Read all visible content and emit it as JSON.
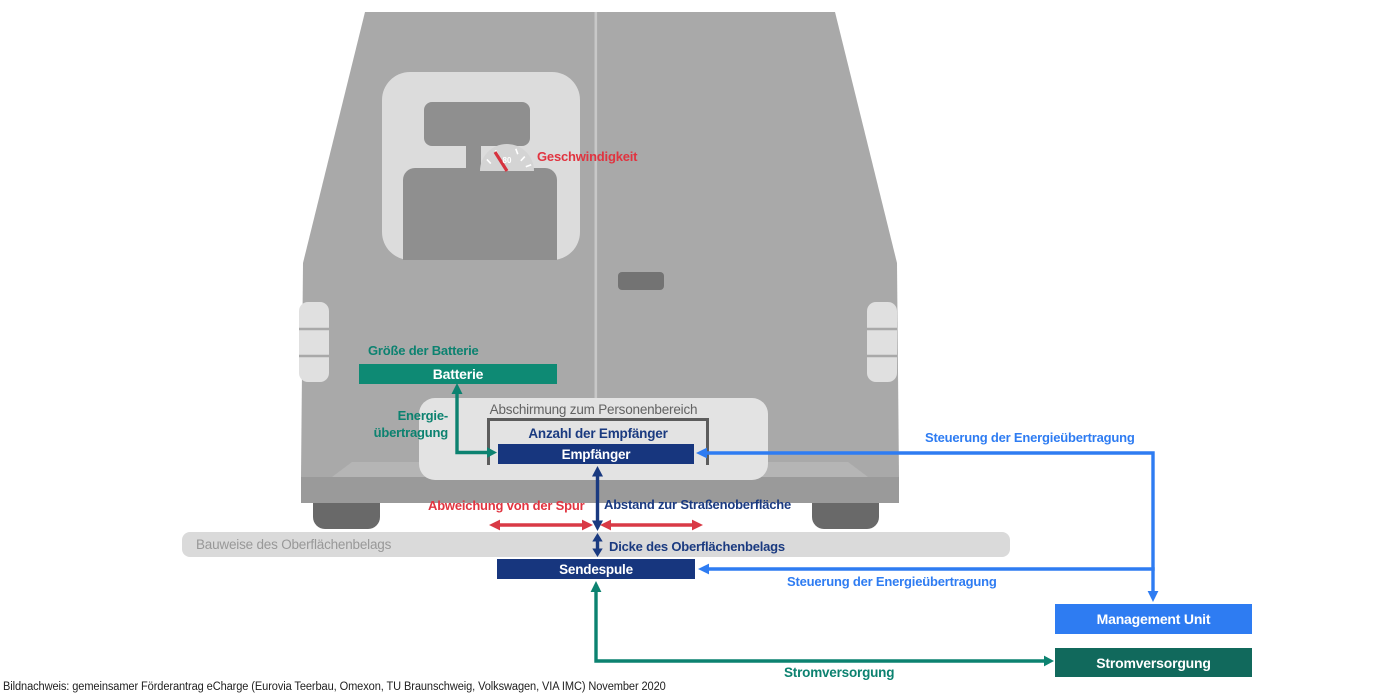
{
  "colors": {
    "teal_line": "#0c8270",
    "teal_box": "#0e8a74",
    "teal_dark_box": "#11695c",
    "navy": "#17367e",
    "blue": "#2e7cf2",
    "red": "#d93a46",
    "van_gray": "#a9a9a9",
    "light_gray": "#e3e3e3"
  },
  "vehicle": {
    "speed_label": "Geschwindigkeit",
    "speedometer_value": "80"
  },
  "battery": {
    "size_label": "Größe der Batterie",
    "box_label": "Batterie",
    "transfer_line1": "Energie-",
    "transfer_line2": "übertragung"
  },
  "shielding": {
    "title": "Abschirmung zum Personenbereich",
    "count_label": "Anzahl der Empfänger",
    "receiver_label": "Empfänger"
  },
  "ground": {
    "deviation_label": "Abweichung von der Spur",
    "distance_label": "Abstand zur Straßenoberfläche",
    "surface_label": "Bauweise des Oberflächenbelags",
    "thickness_label": "Dicke des Oberflächenbelags",
    "coil_label": "Sendespule"
  },
  "control": {
    "upper_label": "Steuerung der Energieübertragung",
    "lower_label": "Steuerung der Energieübertragung"
  },
  "right_panel": {
    "management_label": "Management Unit",
    "power_box_label": "Stromversorgung",
    "power_line_label": "Stromversorgung"
  },
  "caption": "Bildnachweis: gemeinsamer Förderantrag eCharge (Eurovia Teerbau, Omexon, TU Braunschweig, Volkswagen, VIA IMC) November 2020"
}
